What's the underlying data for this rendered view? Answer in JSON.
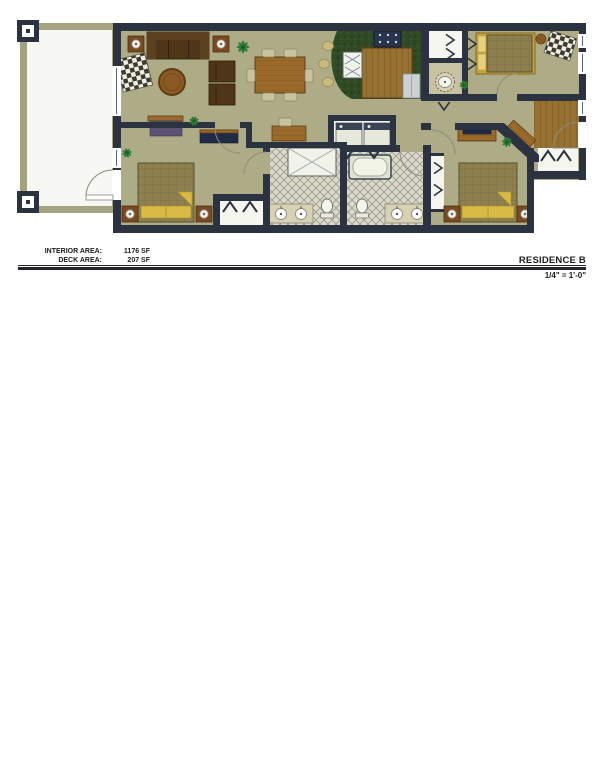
{
  "title_block": {
    "interior_area_label": "INTERIOR AREA:",
    "interior_area_value": "1176 SF",
    "deck_area_label": "DECK AREA:",
    "deck_area_value": "207 SF",
    "residence_name": "RESIDENCE B",
    "scale": "1/4\" = 1'-0\""
  },
  "colors": {
    "wall": "#2b3240",
    "floor": "#aeac87",
    "deck": "#f7f7f3",
    "deck_frame": "#a3a382",
    "counter": "#2f4a24",
    "wood": "#9a6a2b",
    "sofa": "#4f3618",
    "pillow": "#d9ba45",
    "blanket": "#8d7f4e",
    "tile": "#dcdacb",
    "tile_line": "#9a9a8b",
    "fixture": "#f2f3e8",
    "purple": "#5c5273",
    "navy": "#1f2b47",
    "plant": "#2e7c38",
    "stool": "#c9b97e",
    "chair": "#c9c39b",
    "arc": "#8d8d7c"
  }
}
